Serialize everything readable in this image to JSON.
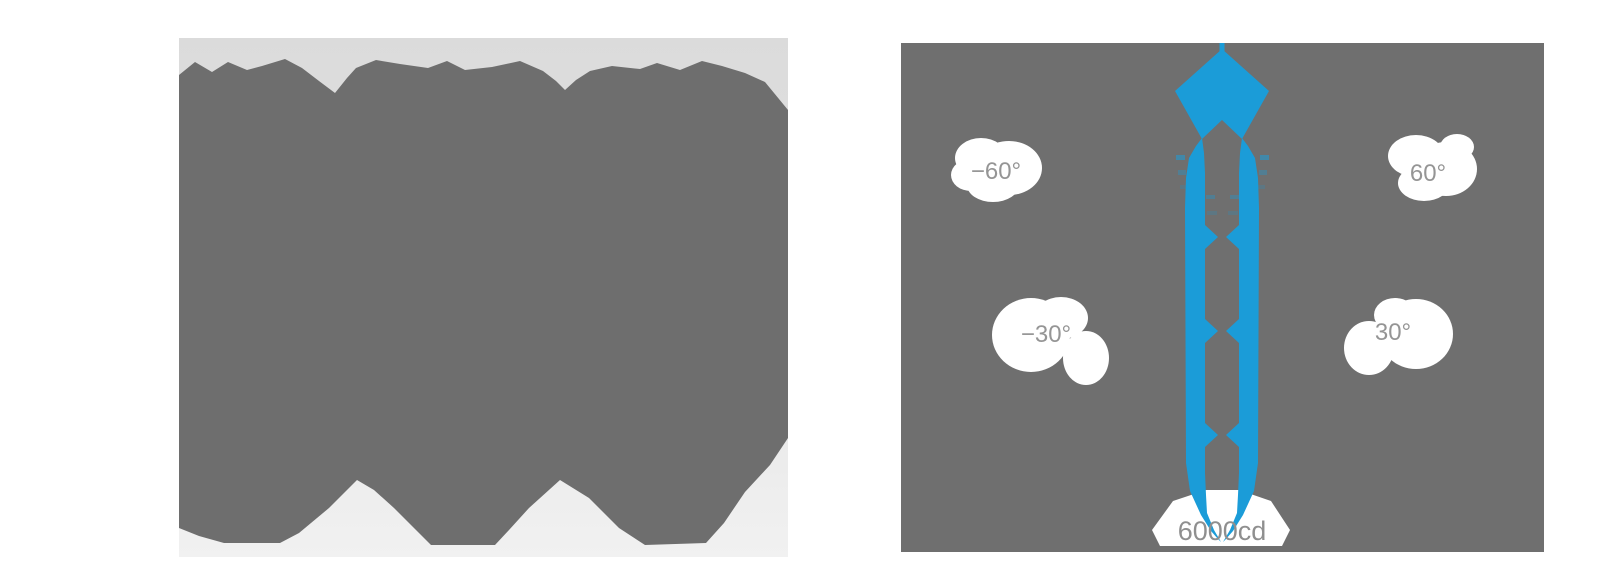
{
  "page": {
    "background": "#ffffff",
    "description": "Product photo silhouette (left) and beam light-distribution diagram (right)"
  },
  "left_panel": {
    "name": "product-image",
    "background_top": "#dbdbdb",
    "background_bottom": "#f1f1f1",
    "silhouette_color": "#6e6e6e"
  },
  "diagram": {
    "background": "#6f6f6f",
    "beam_color": "#1b9cd8",
    "label_text_color": "#959595",
    "label_bubble_color": "#ffffff",
    "labels": {
      "minus60": "−60°",
      "plus60": "60°",
      "minus30": "−30°",
      "plus30": "30°",
      "intensity": "6000cd"
    }
  },
  "chart_data": {
    "type": "polar-beam-diagram",
    "title": "",
    "angle_tick_labels": [
      "−60°",
      "−30°",
      "30°",
      "60°"
    ],
    "angle_ticks_deg": [
      -60,
      -30,
      30,
      60
    ],
    "peak_intensity_label": "6000cd",
    "peak_intensity_cd": 6000,
    "beam_shape": "narrow symmetric lobe pointing down from source at top center",
    "legend_position": "none",
    "grid": "off"
  }
}
